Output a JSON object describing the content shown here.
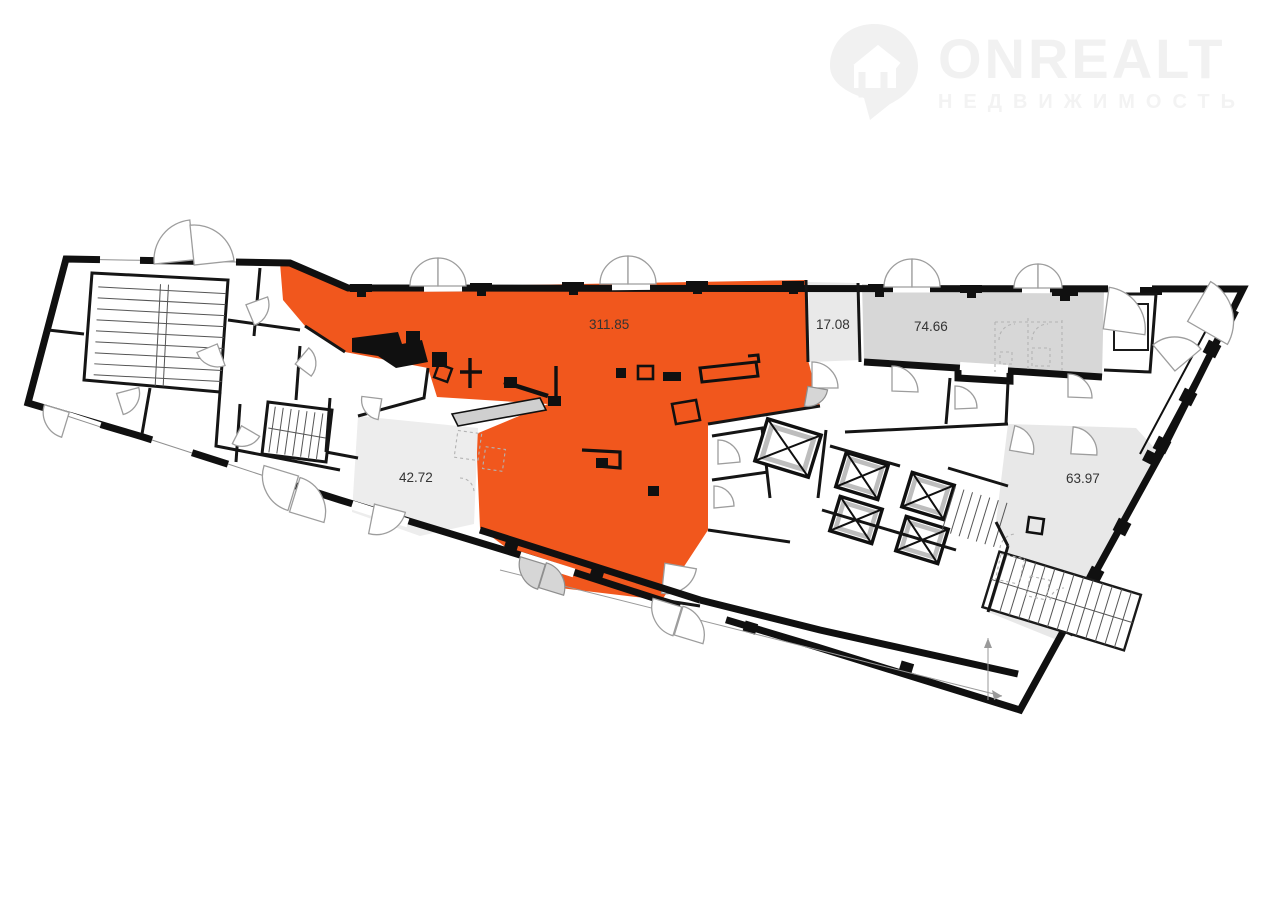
{
  "watermark": {
    "brand": "ONREALT",
    "subtitle": "НЕДВИЖИМОСТЬ"
  },
  "rooms": {
    "main": {
      "label": "311.85",
      "color": "#F1571D",
      "highlighted": true
    },
    "small": {
      "label": "17.08",
      "color": "#E9E9E9",
      "highlighted": false
    },
    "hall": {
      "label": "74.66",
      "color": "#D7D7D7",
      "highlighted": false
    },
    "left": {
      "label": "42.72",
      "color": "#EDEDED",
      "highlighted": false
    },
    "right": {
      "label": "63.97",
      "color": "#E8E8E8",
      "highlighted": false
    }
  },
  "plan": {
    "wall_color": "#101010",
    "background": "#FFFFFF",
    "watermark_color": "#F1F1F1"
  }
}
